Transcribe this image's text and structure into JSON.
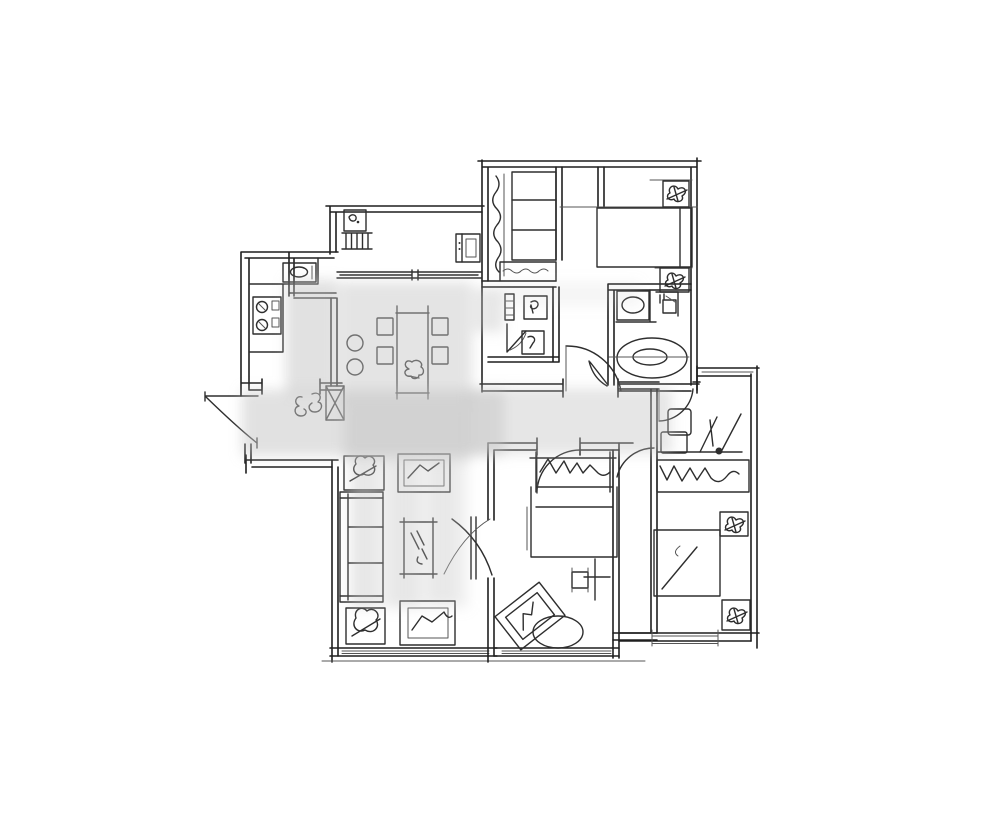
{
  "meta": {
    "kind": "hand-drawn-floor-plan-sketch",
    "canvas": {
      "width": 1000,
      "height": 822
    },
    "has_text_labels": false
  },
  "palette": {
    "background": "#ffffff",
    "wall_line": "#1f1f1f",
    "furniture_line": "#2e2e2e",
    "light_line": "#555555",
    "watermark": "#c4c4c4"
  },
  "watermark": {
    "style": "blurred-gray-blob",
    "blur_px": 6,
    "region": "center cross: horizontal band over hallway, vertical band over dining/living"
  },
  "rooms": [
    {
      "name": "master-suite",
      "contents": [
        "walk-in-closet",
        "double-bed",
        "nightstand-plant",
        "nightstand-plant",
        "closet-shelves",
        "hanging-clothes"
      ]
    },
    {
      "name": "small-bathroom",
      "contents": [
        "towel-rail",
        "toilet",
        "bidet",
        "door-swing"
      ]
    },
    {
      "name": "ensuite-bathroom",
      "contents": [
        "washbasin",
        "toilet",
        "bathtub",
        "door-swing"
      ]
    },
    {
      "name": "balcony-utility",
      "contents": [
        "ac-unit",
        "radiator",
        "cabinet",
        "sliding-door"
      ]
    },
    {
      "name": "kitchen",
      "contents": [
        "sink",
        "counter",
        "stove"
      ]
    },
    {
      "name": "entry-foyer",
      "contents": [
        "entry-door-swing",
        "console-scribble",
        "column"
      ]
    },
    {
      "name": "dining-area",
      "contents": [
        "dining-table",
        "dining-chair",
        "dining-chair",
        "dining-chair",
        "dining-chair",
        "stool",
        "stool",
        "table-plant"
      ]
    },
    {
      "name": "living-room",
      "contents": [
        "sofa",
        "coffee-table",
        "tv-console",
        "tv-console",
        "plant-table",
        "plant-table",
        "door-swing",
        "window"
      ]
    },
    {
      "name": "middle-bedroom",
      "contents": [
        "bed",
        "headboard-pillows",
        "stool",
        "floor-lamp-cross",
        "tilted-frame",
        "oval-rug",
        "window"
      ]
    },
    {
      "name": "right-bedroom",
      "contents": [
        "desk",
        "chair",
        "plant",
        "wardrobe-hangers",
        "nightstand-plant",
        "bed",
        "nightstand-plant",
        "window",
        "door-swing"
      ]
    }
  ]
}
